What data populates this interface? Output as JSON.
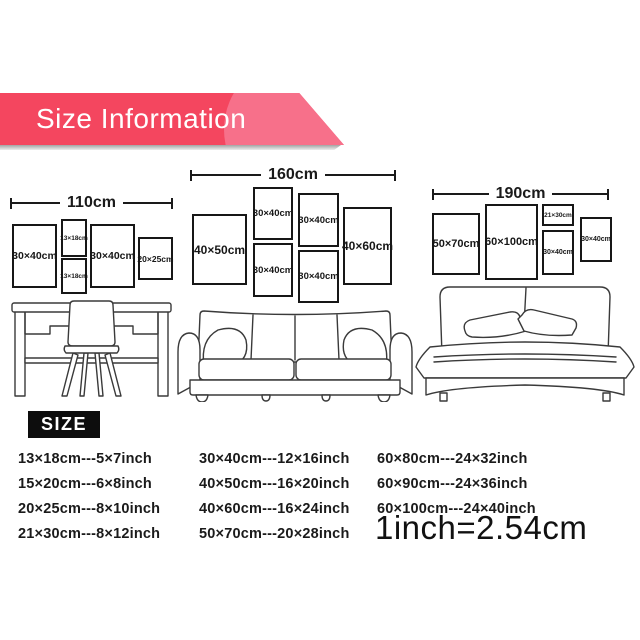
{
  "banner": {
    "title": "Size Information",
    "color": "#f4465f",
    "highlight_color": "#f7708a"
  },
  "layouts": [
    {
      "name": "desk-wall",
      "width_label": "110cm",
      "frames": [
        {
          "label": "30×40cm"
        },
        {
          "label": "13×18cm"
        },
        {
          "label": "13×18cm"
        },
        {
          "label": "30×40cm"
        },
        {
          "label": "20×25cm"
        }
      ]
    },
    {
      "name": "sofa-wall",
      "width_label": "160cm",
      "frames": [
        {
          "label": "40×50cm"
        },
        {
          "label": "30×40cm"
        },
        {
          "label": "30×40cm"
        },
        {
          "label": "30×40cm"
        },
        {
          "label": "30×40cm"
        },
        {
          "label": "40×60cm"
        }
      ]
    },
    {
      "name": "bed-wall",
      "width_label": "190cm",
      "frames": [
        {
          "label": "50×70cm"
        },
        {
          "label": "60×100cm"
        },
        {
          "label": "21×30cm"
        },
        {
          "label": "30×40cm"
        },
        {
          "label": "30×40cm"
        }
      ]
    }
  ],
  "size_section": {
    "heading": "SIZE",
    "columns": [
      [
        "13×18cm---5×7inch",
        "15×20cm---6×8inch",
        "20×25cm---8×10inch",
        "21×30cm---8×12inch"
      ],
      [
        "30×40cm---12×16inch",
        "40×50cm---16×20inch",
        "40×60cm---16×24inch",
        "50×70cm---20×28inch"
      ],
      [
        "60×80cm---24×32inch",
        "60×90cm---24×36inch",
        "60×100cm---24×40inch"
      ]
    ],
    "conversion_note": "1inch=2.54cm"
  }
}
